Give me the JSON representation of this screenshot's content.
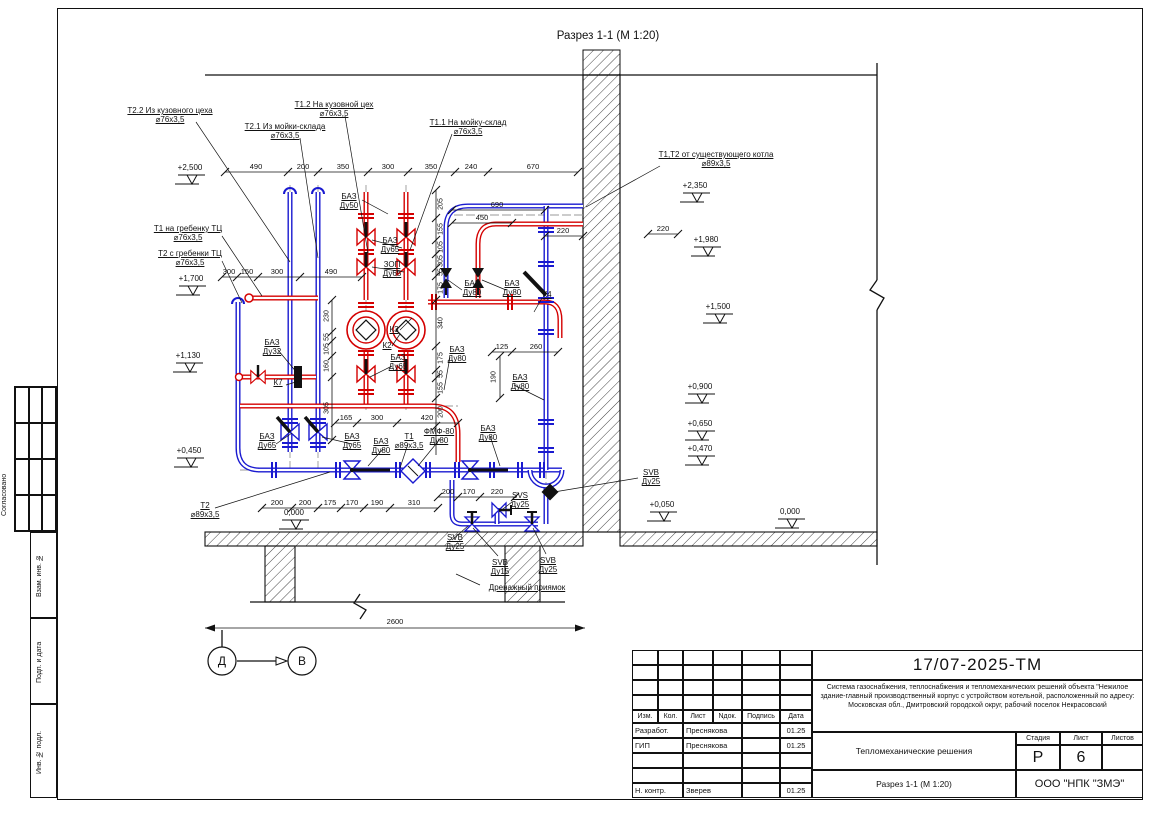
{
  "page": {
    "section_title": "Разрез 1-1 (М 1:20)"
  },
  "markers": {
    "left": "Д",
    "right": "В"
  },
  "frame_strip": {
    "approved": "Согласовано",
    "inv_alt": "Взам. инв. №",
    "sign_date": "Подп. и дата",
    "inv_orig": "Инв. № подл."
  },
  "callouts": [
    {
      "text": "Т2.2 Из кузовного цеха",
      "sub": "⌀76х3,5"
    },
    {
      "text": "Т2.1 Из мойки-склада",
      "sub": "⌀76х3,5"
    },
    {
      "text": "Т1.2 На кузовной цех",
      "sub": "⌀76х3,5"
    },
    {
      "text": "Т1.1 На мойку-склад",
      "sub": "⌀76х3,5"
    },
    {
      "text": "Т1,Т2 от существующего котла",
      "sub": "⌀89х3,5"
    },
    {
      "text": "Т1 на гребенку ТЦ",
      "sub": "⌀76х3,5"
    },
    {
      "text": "Т2 с гребенки ТЦ",
      "sub": "⌀76х3,5"
    },
    {
      "text": "БАЗ",
      "sub": "Ду50"
    },
    {
      "text": "БАЗ",
      "sub": "Ду65"
    },
    {
      "text": "ЗОП",
      "sub": "Ду65"
    },
    {
      "text": "К3",
      "sub": ""
    },
    {
      "text": "К2",
      "sub": ""
    },
    {
      "text": "БАЗ",
      "sub": "Ду80"
    },
    {
      "text": "БАЗ",
      "sub": "Ду80"
    },
    {
      "text": "К4",
      "sub": ""
    },
    {
      "text": "БАЗ",
      "sub": "Ду32"
    },
    {
      "text": "К7",
      "sub": ""
    },
    {
      "text": "БАЗ",
      "sub": "Ду65"
    },
    {
      "text": "БАЗ",
      "sub": "Ду80"
    },
    {
      "text": "БАЗ",
      "sub": "Ду80"
    },
    {
      "text": "БАЗ",
      "sub": "Ду65"
    },
    {
      "text": "БАЗ",
      "sub": "Ду65"
    },
    {
      "text": "БАЗ",
      "sub": "Ду80"
    },
    {
      "text": "Т1",
      "sub": "⌀89х3,5"
    },
    {
      "text": "ФМФ-80",
      "sub": "Ду80"
    },
    {
      "text": "БАЗ",
      "sub": "Ду80"
    },
    {
      "text": "SVB",
      "sub": "Ду25"
    },
    {
      "text": "SVS",
      "sub": "Ду25"
    },
    {
      "text": "SVB",
      "sub": "Ду25"
    },
    {
      "text": "SVB",
      "sub": "Ду15"
    },
    {
      "text": "SVB",
      "sub": "Ду25"
    },
    {
      "text": "Дренажный приямок",
      "sub": ""
    },
    {
      "text": "Т2",
      "sub": "⌀89х3,5"
    }
  ],
  "elevations": {
    "left": [
      "+2,500",
      "+1,700",
      "+1,130",
      "+0,450"
    ],
    "zero_center": "0,000",
    "right": [
      "+2,350",
      "+1,980",
      "+1,500",
      "+0,900",
      "+0,650",
      "+0,470",
      "+0,050",
      "0,000"
    ]
  },
  "dims": {
    "top": [
      "490",
      "200",
      "350",
      "300",
      "350",
      "240",
      "670"
    ],
    "mid": [
      "300",
      "150",
      "300",
      "490"
    ],
    "boiler": [
      "690",
      "450",
      "220"
    ],
    "right_extra": "220",
    "pump_area": [
      "125",
      "260",
      "190"
    ],
    "lower": [
      "165",
      "300",
      "420"
    ],
    "bottom": [
      "200",
      "200",
      "175",
      "170",
      "190",
      "310"
    ],
    "bottom_right": [
      "200",
      "170",
      "220"
    ],
    "v_inner": [
      "230",
      "55",
      "105",
      "160",
      "305"
    ],
    "v_outer": [
      "205",
      "155",
      "105",
      "305",
      "55",
      "175",
      "340",
      "175",
      "55",
      "155",
      "200"
    ],
    "total": "2600"
  },
  "title_block": {
    "doc_number": "17/07-2025-ТМ",
    "description": "Система газоснабжения, теплоснабжения и тепломеханических решений объекта \"Нежилое здание-главный производственный корпус с устройством котельной, расположенный по адресу: Московская обл., Дмитровский городской округ, рабочий поселок Некрасовский",
    "columns": [
      "Изм.",
      "Кол.",
      "Лист",
      "Nдок.",
      "Подпись",
      "Дата"
    ],
    "rows": [
      {
        "role": "Разработ.",
        "name": "Преснякова",
        "sign": "",
        "date": "01.25"
      },
      {
        "role": "ГИП",
        "name": "Преснякова",
        "sign": "",
        "date": "01.25"
      },
      {
        "role": "",
        "name": "",
        "sign": "",
        "date": ""
      },
      {
        "role": "",
        "name": "",
        "sign": "",
        "date": ""
      },
      {
        "role": "Н. контр.",
        "name": "Зверев",
        "sign": "",
        "date": "01.25"
      }
    ],
    "section_name": "Тепломеханические решения",
    "stage_label": "Стадия",
    "sheet_label": "Лист",
    "sheets_label": "Листов",
    "stage": "Р",
    "sheet": "6",
    "sheets": "",
    "view_title": "Разрез 1-1 (М 1:20)",
    "company": "ООО \"НПК \"ЗМЭ\""
  },
  "colors": {
    "supply": "#d40000",
    "return": "#1a1ad0",
    "lines": "#111111"
  }
}
